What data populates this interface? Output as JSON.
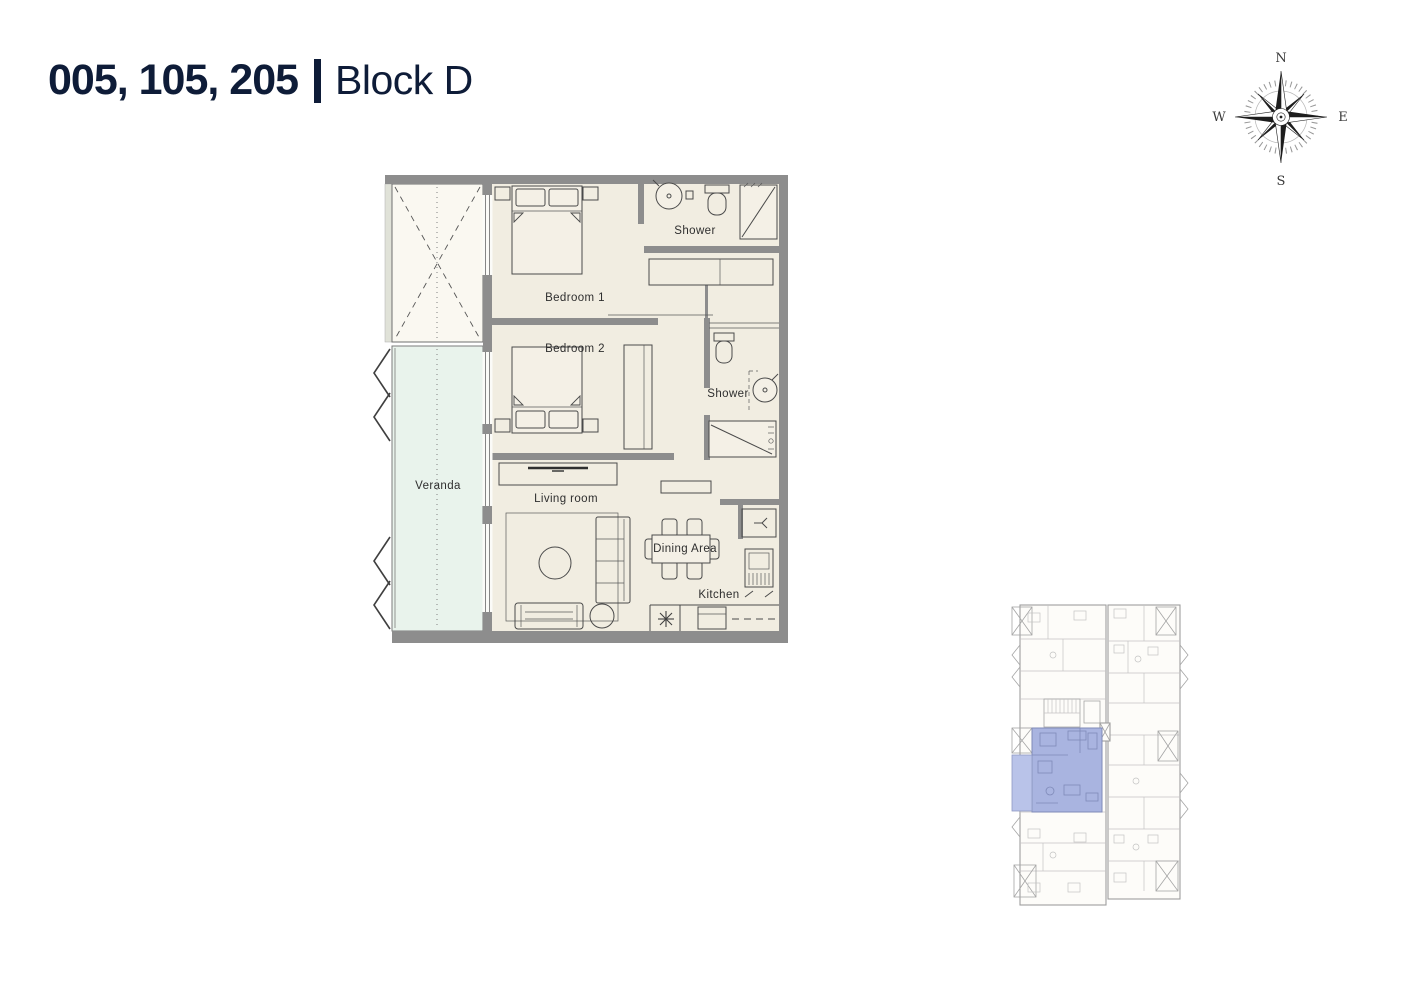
{
  "header": {
    "unit_numbers": "005, 105, 205",
    "block_name": "Block D",
    "text_color": "#0e1c38"
  },
  "compass": {
    "north": "N",
    "east": "E",
    "south": "S",
    "west": "W"
  },
  "floor_plan": {
    "labels": {
      "shower_top": "Shower",
      "bedroom1": "Bedroom 1",
      "bedroom2": "Bedroom 2",
      "shower_mid": "Shower",
      "veranda": "Veranda",
      "living_room": "Living room",
      "dining_area": "Dining Area",
      "kitchen": "Kitchen"
    },
    "colors": {
      "wall": "#8d8d8d",
      "floor": "#f1ede1",
      "veranda": "#e9f3ec",
      "void_area": "#faf8f1",
      "furniture_line": "#4a4a4a"
    }
  },
  "key_plan": {
    "colors": {
      "outline": "#9e9e9e",
      "highlight_unit": "#a9b4e0",
      "highlight_veranda": "#b9c3e9"
    }
  }
}
